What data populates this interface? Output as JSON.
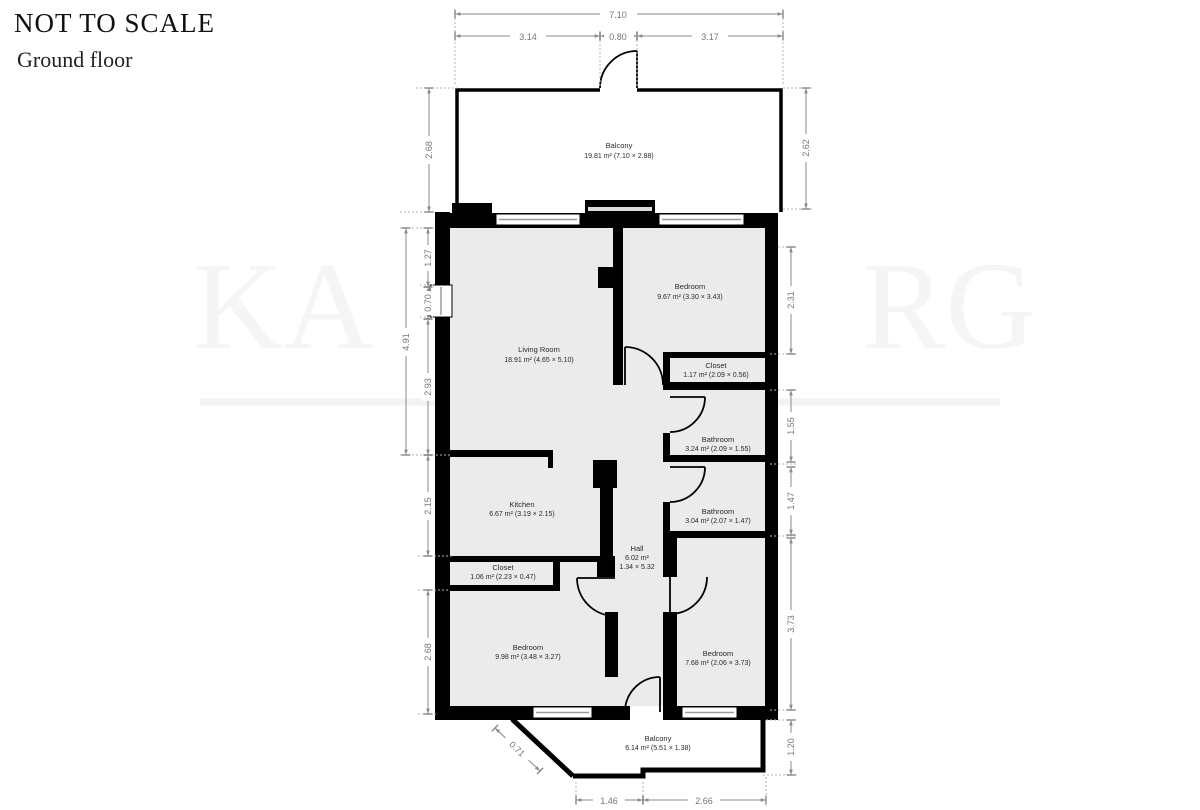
{
  "header": {
    "title": "NOT TO SCALE",
    "subtitle": "Ground floor"
  },
  "watermark": {
    "left": "KA",
    "right": "RG"
  },
  "rooms": [
    {
      "id": "balcony-top",
      "name": "Balcony",
      "area": "19.81 m² (7.10 × 2.88)"
    },
    {
      "id": "living-room",
      "name": "Living Room",
      "area": "18.91 m² (4.65 × 5.10)"
    },
    {
      "id": "bedroom-top",
      "name": "Bedroom",
      "area": "9.67 m² (3.30 × 3.43)"
    },
    {
      "id": "closet-top",
      "name": "Closet",
      "area": "1.17 m² (2.09 × 0.56)"
    },
    {
      "id": "bathroom-1",
      "name": "Bathroom",
      "area": "3.24 m² (2.09 × 1.55)"
    },
    {
      "id": "bathroom-2",
      "name": "Bathroom",
      "area": "3.04 m² (2.07 × 1.47)"
    },
    {
      "id": "hall",
      "name": "Hall",
      "area": "6.02 m²",
      "dims": "1.34 × 5.32"
    },
    {
      "id": "kitchen",
      "name": "Kitchen",
      "area": "6.67 m² (3.19 × 2.15)"
    },
    {
      "id": "closet-bottom",
      "name": "Closet",
      "area": "1.06 m² (2.23 × 0.47)"
    },
    {
      "id": "bedroom-left",
      "name": "Bedroom",
      "area": "9.98 m² (3.48 × 3.27)"
    },
    {
      "id": "bedroom-right",
      "name": "Bedroom",
      "area": "7.68 m² (2.06 × 3.73)"
    },
    {
      "id": "balcony-bottom",
      "name": "Balcony",
      "area": "6.14 m² (5.51 × 1.38)"
    }
  ],
  "dimensions": {
    "top": [
      "7.10",
      "3.14",
      "0.80",
      "3.17"
    ],
    "left": [
      "2.68",
      "1.27",
      "0.70",
      "4.91",
      "2.93",
      "2.15",
      "2.68"
    ],
    "right": [
      "2.62",
      "2.31",
      "1.55",
      "1.47",
      "3.73",
      "1.20"
    ],
    "bottom": [
      "1.46",
      "2.66"
    ],
    "diagonal": "0.71"
  },
  "colors": {
    "wall": "#000000",
    "room_fill": "#ebebeb",
    "dimension_text": "#757575",
    "label_text": "#2a2a2a",
    "watermark": "#f5f5f5"
  }
}
